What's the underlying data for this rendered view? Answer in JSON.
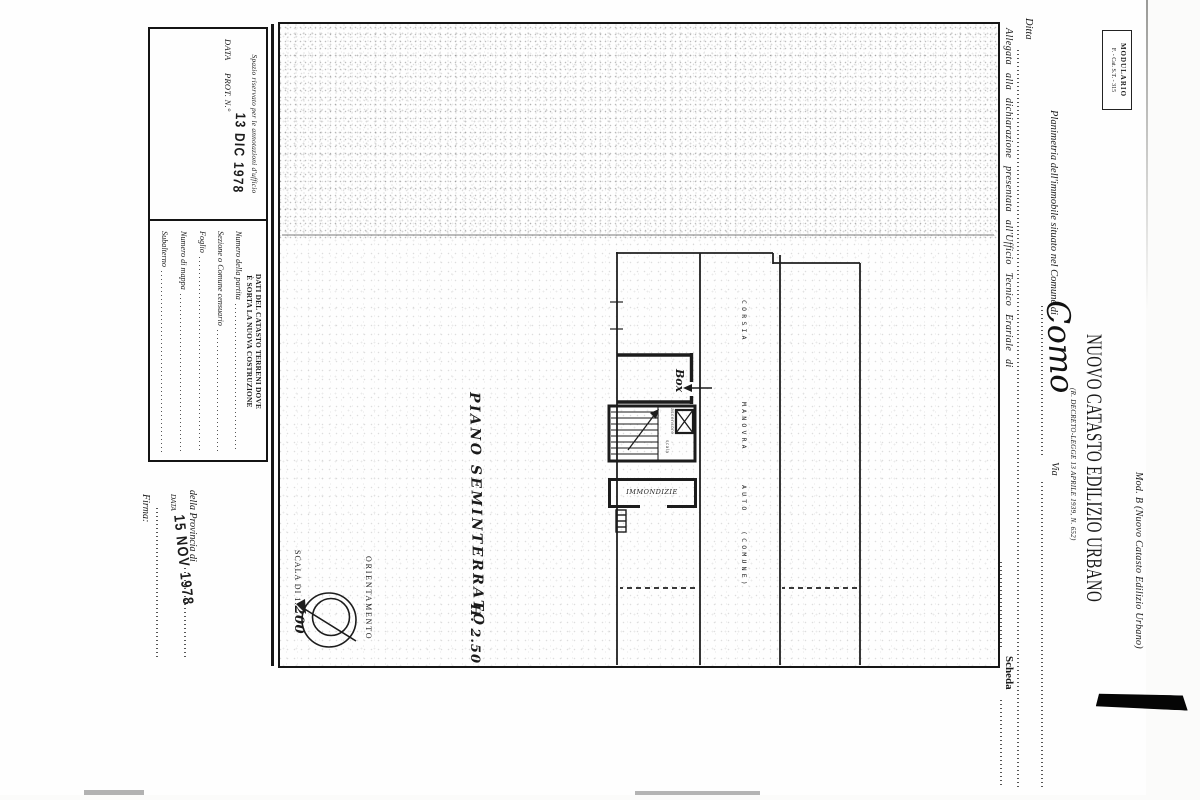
{
  "form": {
    "modulario_line1": "MODULARIO",
    "modulario_line2": "F. - Cat. S.T. - 315",
    "mod_b": "Mod. B (Nuovo Catasto Edilizio Urbano)",
    "title": "NUOVO CATASTO EDILIZIO URBANO",
    "subtitle": "(R. DECRETO-LEGGE 13 APRILE 1939, N. 652)",
    "planimetria_label": "Planimetria dell'immobile situato nel Comune di",
    "comune_value": "Como",
    "via_label": "Via",
    "ditta_label": "Ditta",
    "allegata_label": "Allegata alla dichiarazione presentata all'Ufficio Tecnico Erariale di",
    "scheda_label": "Scheda"
  },
  "plan": {
    "room_box": "Box",
    "room_immondizie": "IMMONDIZIE",
    "stair_label": "scala",
    "shaft_label": "ascensore",
    "corsia": "CORSIA",
    "manovra": "MANOVRA",
    "auto": "AUTO",
    "comune_paren": "(COMUNE)",
    "caption": "PIANO SEMINTERRATO",
    "height_note": "H. 2.50",
    "orientamento": "ORIENTAMENTO",
    "scala_prefix": "SCALA DI 1:",
    "scala_value": "200"
  },
  "annotations_box": {
    "header": "Spazio riservato per le annotazioni d'ufficio",
    "data_label": "DATA",
    "prot_label": "PROT. N.°",
    "stamp_date": "13 DIC 1978"
  },
  "catasto_box": {
    "header_line1": "DATI DEL CATASTO TERRENI DOVE",
    "header_line2": "È SORTA LA NUOVA COSTRUZIONE",
    "fields": [
      "Numero della partita",
      "Sezione o Comune censuario",
      "Foglio",
      "Numero di mappa",
      "Subalterno"
    ]
  },
  "province_section": {
    "provincia_label": "della Provincia di",
    "data_label": "DATA",
    "stamp_date": "15 NOV 1978",
    "firma_label": "Firma:"
  }
}
